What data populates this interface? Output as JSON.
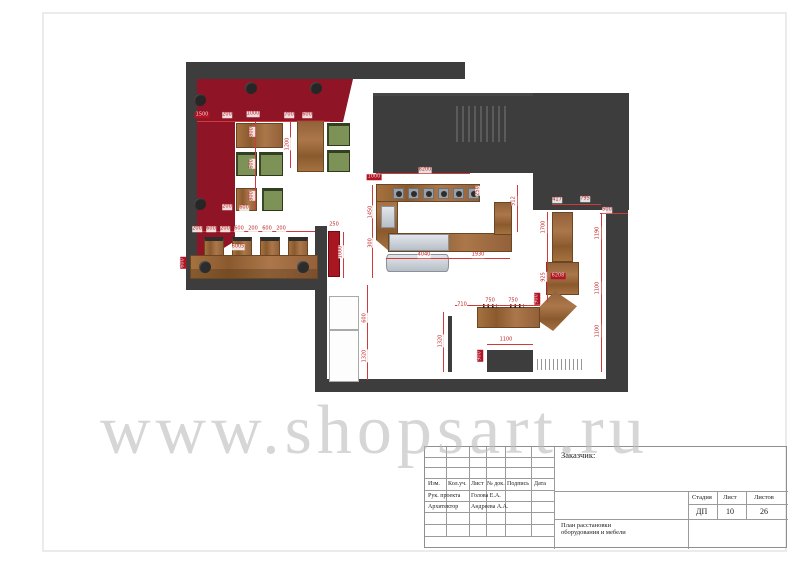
{
  "watermark": {
    "text": "www.shopsart.ru",
    "color": "#bdbdbd"
  },
  "title_block": {
    "customer_label": "Заказчик:",
    "header_cols": [
      "Изм.",
      "Кол.уч.",
      "Лист",
      "№ док.",
      "Подпись",
      "Дата"
    ],
    "signature_rows": [
      {
        "role": "Рук. проекта",
        "name": "Голова Е.А."
      },
      {
        "role": "Архитектор",
        "name": "Андреева А.А."
      }
    ],
    "stage_label": "Стадия",
    "stage_value": "ДП",
    "sheet_label": "Лист",
    "sheet_value": "10",
    "sheets_label": "Листов",
    "sheets_value": "26",
    "drawing_title_line1": "План расстановки",
    "drawing_title_line2": "оборудования  и мебели"
  },
  "plan": {
    "colors": {
      "wall": "#3d3d3d",
      "banquette_red": "#8f1425",
      "accent_red_cabinet": "#a81622",
      "wood": "#9c6b3c",
      "seat_green": "#7c9257",
      "display_gray": "#ccd1d8",
      "dimension_red": "#c22525"
    },
    "dimensions": [
      {
        "t": "1500",
        "x": 202,
        "y": 115,
        "v": false,
        "b": true
      },
      {
        "t": "200",
        "x": 227,
        "y": 115,
        "v": false,
        "b": false
      },
      {
        "t": "1000",
        "x": 253,
        "y": 114,
        "v": false,
        "b": false
      },
      {
        "t": "700",
        "x": 289,
        "y": 115,
        "v": false,
        "b": false
      },
      {
        "t": "600",
        "x": 307,
        "y": 115,
        "v": false,
        "b": false
      },
      {
        "t": "800",
        "x": 252,
        "y": 132,
        "v": true,
        "b": false
      },
      {
        "t": "1200",
        "x": 288,
        "y": 144,
        "v": true,
        "b": false
      },
      {
        "t": "600",
        "x": 252,
        "y": 164,
        "v": true,
        "b": false
      },
      {
        "t": "800",
        "x": 252,
        "y": 196,
        "v": true,
        "b": false
      },
      {
        "t": "200",
        "x": 227,
        "y": 207,
        "v": false,
        "b": false
      },
      {
        "t": "600",
        "x": 244,
        "y": 208,
        "v": false,
        "b": false
      },
      {
        "t": "600",
        "x": 183,
        "y": 263,
        "v": true,
        "b": true
      },
      {
        "t": "200",
        "x": 197,
        "y": 229,
        "v": false,
        "b": false
      },
      {
        "t": "600",
        "x": 211,
        "y": 229,
        "v": false,
        "b": false
      },
      {
        "t": "200",
        "x": 225,
        "y": 229,
        "v": false,
        "b": false
      },
      {
        "t": "600",
        "x": 239,
        "y": 229,
        "v": false,
        "b": false
      },
      {
        "t": "200",
        "x": 253,
        "y": 229,
        "v": false,
        "b": false
      },
      {
        "t": "600",
        "x": 267,
        "y": 229,
        "v": false,
        "b": false
      },
      {
        "t": "200",
        "x": 281,
        "y": 229,
        "v": false,
        "b": false
      },
      {
        "t": "6005",
        "x": 238,
        "y": 247,
        "v": false,
        "b": false
      },
      {
        "t": "250",
        "x": 334,
        "y": 225,
        "v": false,
        "b": false
      },
      {
        "t": "1000",
        "x": 341,
        "y": 252,
        "v": true,
        "b": false
      },
      {
        "t": "300",
        "x": 371,
        "y": 243,
        "v": true,
        "b": false
      },
      {
        "t": "600",
        "x": 365,
        "y": 318,
        "v": true,
        "b": false
      },
      {
        "t": "1320",
        "x": 365,
        "y": 356,
        "v": true,
        "b": false
      },
      {
        "t": "1000",
        "x": 374,
        "y": 177,
        "v": false,
        "b": true
      },
      {
        "t": "8200",
        "x": 425,
        "y": 170,
        "v": false,
        "b": false
      },
      {
        "t": "250",
        "x": 478,
        "y": 191,
        "v": true,
        "b": false
      },
      {
        "t": "1450",
        "x": 371,
        "y": 212,
        "v": true,
        "b": false
      },
      {
        "t": "4040",
        "x": 424,
        "y": 255,
        "v": false,
        "b": false
      },
      {
        "t": "1930",
        "x": 478,
        "y": 255,
        "v": false,
        "b": false
      },
      {
        "t": "512",
        "x": 514,
        "y": 201,
        "v": true,
        "b": false
      },
      {
        "t": "417",
        "x": 557,
        "y": 200,
        "v": false,
        "b": false
      },
      {
        "t": "795",
        "x": 585,
        "y": 199,
        "v": false,
        "b": false
      },
      {
        "t": "500",
        "x": 607,
        "y": 210,
        "v": false,
        "b": false
      },
      {
        "t": "1700",
        "x": 544,
        "y": 227,
        "v": true,
        "b": false
      },
      {
        "t": "1190",
        "x": 598,
        "y": 233,
        "v": true,
        "b": false
      },
      {
        "t": "925",
        "x": 544,
        "y": 277,
        "v": true,
        "b": false
      },
      {
        "t": "6208",
        "x": 558,
        "y": 276,
        "v": false,
        "b": true
      },
      {
        "t": "1100",
        "x": 598,
        "y": 288,
        "v": true,
        "b": false
      },
      {
        "t": "900",
        "x": 537,
        "y": 299,
        "v": true,
        "b": true
      },
      {
        "t": "750",
        "x": 490,
        "y": 301,
        "v": false,
        "b": false
      },
      {
        "t": "750",
        "x": 513,
        "y": 301,
        "v": false,
        "b": false
      },
      {
        "t": "710",
        "x": 462,
        "y": 305,
        "v": false,
        "b": false
      },
      {
        "t": "1320",
        "x": 441,
        "y": 341,
        "v": true,
        "b": false
      },
      {
        "t": "1100",
        "x": 506,
        "y": 340,
        "v": false,
        "b": false
      },
      {
        "t": "900",
        "x": 480,
        "y": 356,
        "v": true,
        "b": true
      },
      {
        "t": "1100",
        "x": 598,
        "y": 331,
        "v": true,
        "b": false
      }
    ]
  }
}
